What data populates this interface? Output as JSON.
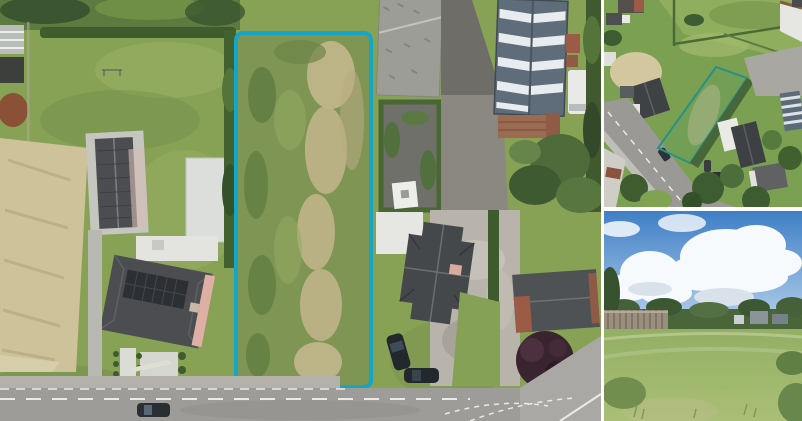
{
  "page": {
    "background": "#ffffff",
    "kind": "property-photo-collage"
  },
  "panels": {
    "main_aerial": {
      "description": "Top-down drone photo of a long rectangular building plot outlined in cyan, between a house with solar panels on the left and farm buildings on the right, with a road along the bottom",
      "width": 601,
      "height": 421
    },
    "secondary_aerial": {
      "description": "Oblique drone photo of the neighbourhood with the same plot outlined in teal beside a road and houses",
      "width": 198,
      "height": 207
    },
    "ground_photo": {
      "description": "Ground-level photo of the overgrown grassy plot under a blue sky with large white clouds, wooden fence on the left",
      "width": 198,
      "height": 210
    }
  },
  "overlay": {
    "plot_outline_main_color": "#14a6c8",
    "plot_outline_secondary_color": "#2a9184"
  },
  "colors": {
    "gap": "#ffffff",
    "parcelMain": "#14a6c8",
    "parcelSecondary": "#2a9184",
    "grass": "#87a155",
    "grassLight": "#9ab366",
    "grassDark": "#6f8c49",
    "scrub": "#7e9553",
    "hedge": "#3f5c2e",
    "treeDark": "#3a5530",
    "dirtTan": "#c3b68d",
    "fieldTan": "#cec29b",
    "roofDark": "#4b4d50",
    "solar": "#2c3034",
    "salmon": "#ddafa5",
    "whiteSurface": "#e6e7e3",
    "concrete": "#b9b9b3",
    "stoneRoof": "#9d9d97",
    "metalBarn": "#5f6d7a",
    "metalStripe": "#e8ecee",
    "brickRed": "#9b5b46",
    "gravelDark": "#75736d",
    "gravelLight": "#b8b4ac",
    "road": "#9e9c98",
    "roadLight": "#aaa8a4",
    "marking": "#eceae4",
    "carDark": "#2a2f34",
    "van": "#e9eae8",
    "purpleTree": "#3a2430",
    "skyTop": "#3f7ec6",
    "skyBottom": "#b9d4ec",
    "cloud": "#f7fafc",
    "cloudShade": "#d9e2ea",
    "horizonTree": "#4a653a",
    "fenceWood": "#9a8f7e",
    "fieldGreen": "#93af63",
    "fieldGreenLight": "#aabf76"
  }
}
